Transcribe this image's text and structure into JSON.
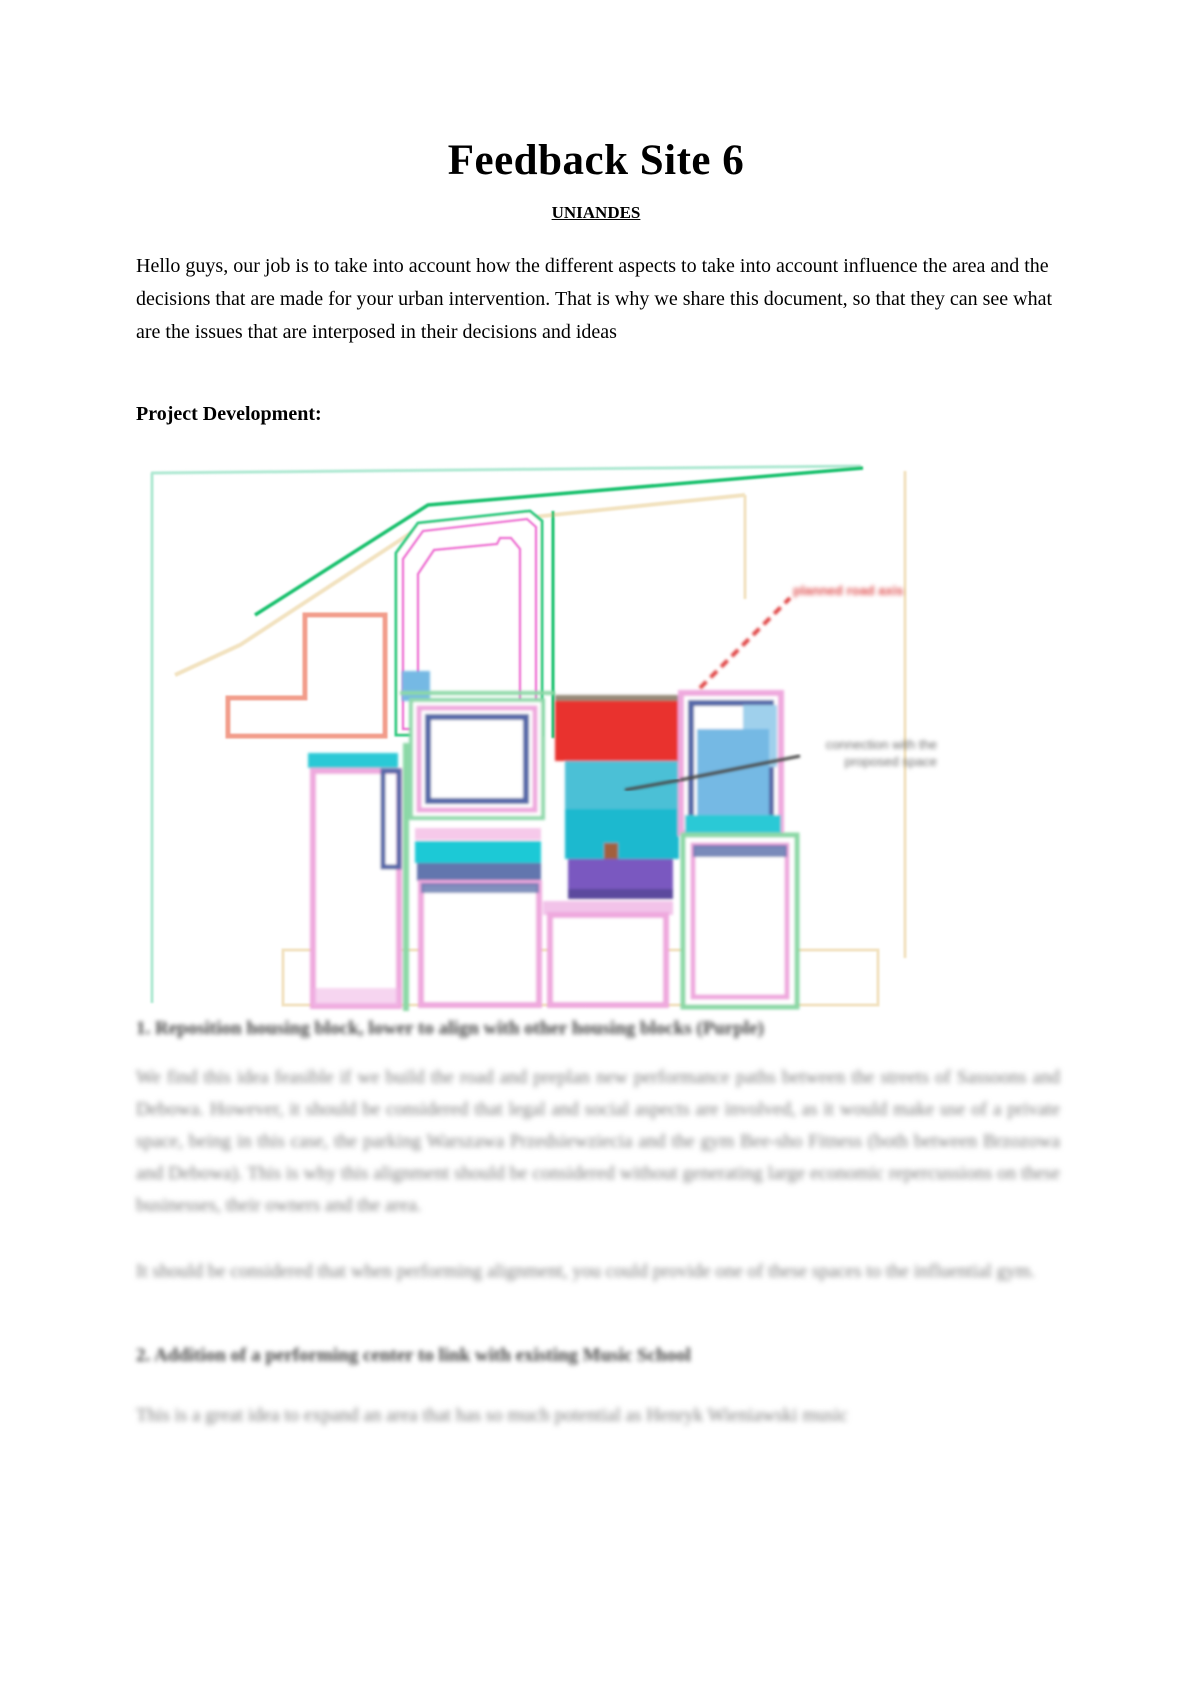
{
  "page": {
    "title": "Feedback Site 6",
    "subtitle": "UNIANDES"
  },
  "intro": {
    "text": "Hello guys, our job is to take into account how the different aspects to take into account influence the area and the decisions that are made for your urban intervention. That is why we share this document, so that they can see what are the issues that are interposed in their decisions and ideas"
  },
  "sections": {
    "project_development_heading": "Project Development:"
  },
  "map": {
    "description": "blurred urban site plan sketch with colored building blocks and road lines",
    "red_dashed_label_blurred": "planned road axis",
    "gray_annotation_blurred_line1": "connection with the",
    "gray_annotation_blurred_line2": "proposed space",
    "colors": {
      "road_green": "#12c06c",
      "border_teal": "#aee8d2",
      "road_cream": "#f2e2bf",
      "block_magenta": "#ef6ad4",
      "block_pink": "#efa9de",
      "block_salmon": "#f29c8a",
      "block_red_fill": "#e9302f",
      "block_teal_fill": "#1ec9d6",
      "block_lightblue_fill": "#74b9e4",
      "block_navy": "#5568a8",
      "block_purple_fill": "#7a58c0",
      "dashed_red": "#e04545",
      "annotation_gray": "#6e6e6e"
    }
  },
  "feedback": {
    "item1": {
      "heading_blurred": "1. Reposition housing block, lower to align with other housing blocks (Purple)",
      "paragraph_1_blurred": "We find this idea feasible if we build the road and preplan new performance paths between the streets of Sassoons and Debowa. However, it should be considered that legal and social aspects are involved, as it would make use of a private space, being in this case, the parking Warszawa Przedsiewziecia and the gym Bee-sho Fitness (both between Brzozowa and Debowa). This is why this alignment should be considered without generating large economic repercussions on these businesses, their owners and the area.",
      "paragraph_2_blurred": "It should be considered that when performing alignment, you could provide one of these spaces to the influential gym."
    },
    "item2": {
      "heading_blurred": "2. Addition of a performing center to link with existing Music School",
      "paragraph_blurred": "This is a great idea to expand an area that has so much potential as Henryk Wieniawski music"
    }
  }
}
